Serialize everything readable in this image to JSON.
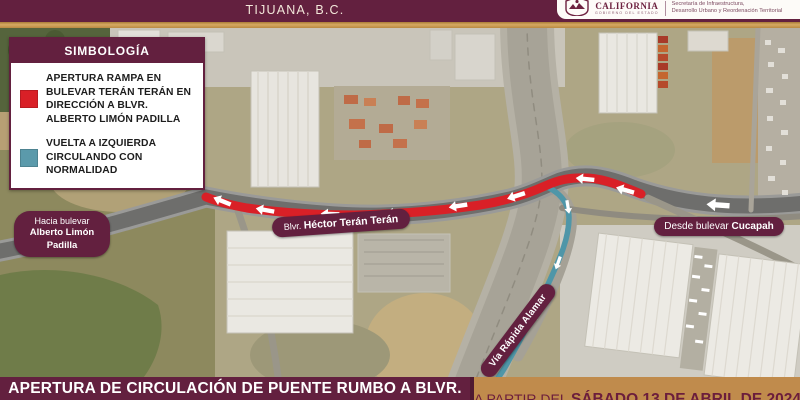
{
  "header": {
    "title": "TIJUANA, B.C."
  },
  "logo": {
    "brand": "CALIFORNIA",
    "brand_sub": "GOBIERNO DEL ESTADO",
    "agency_line1": "Secretaría de Infraestructura,",
    "agency_line2": "Desarrollo Urbano y Reordenación Territorial"
  },
  "legend": {
    "title": "SIMBOLOGÍA",
    "items": [
      {
        "color": "#d92027",
        "label": "APERTURA RAMPA EN BULEVAR TERÁN TERÁN EN DIRECCIÓN A BLVR. ALBERTO LIMÓN PADILLA"
      },
      {
        "color": "#5b9aab",
        "label": "VUELTA A IZQUIERDA CIRCULANDO CON NORMALIDAD"
      }
    ]
  },
  "map": {
    "labels": {
      "hacia": {
        "line1": "Hacia bulevar",
        "line2": "Alberto Limón Padilla"
      },
      "teran": {
        "prefix": "Blvr.",
        "name": "Héctor Terán Terán"
      },
      "cucapah": {
        "prefix": "Desde bulevar",
        "name": "Cucapah"
      },
      "via": {
        "text": "Vía Rápida Alamar"
      }
    }
  },
  "footer": {
    "left": "APERTURA DE CIRCULACIÓN DE PUENTE RUMBO A BLVR.",
    "right_prefix": "A PARTIR DEL",
    "right_date": "SÁBADO 13 DE ABRIL DE 2024"
  },
  "colors": {
    "maroon": "#63203F",
    "gold": "#C7964B",
    "tan_bar": "#C08B4C",
    "route_red": "#D92027",
    "route_teal": "#4F96A8"
  }
}
